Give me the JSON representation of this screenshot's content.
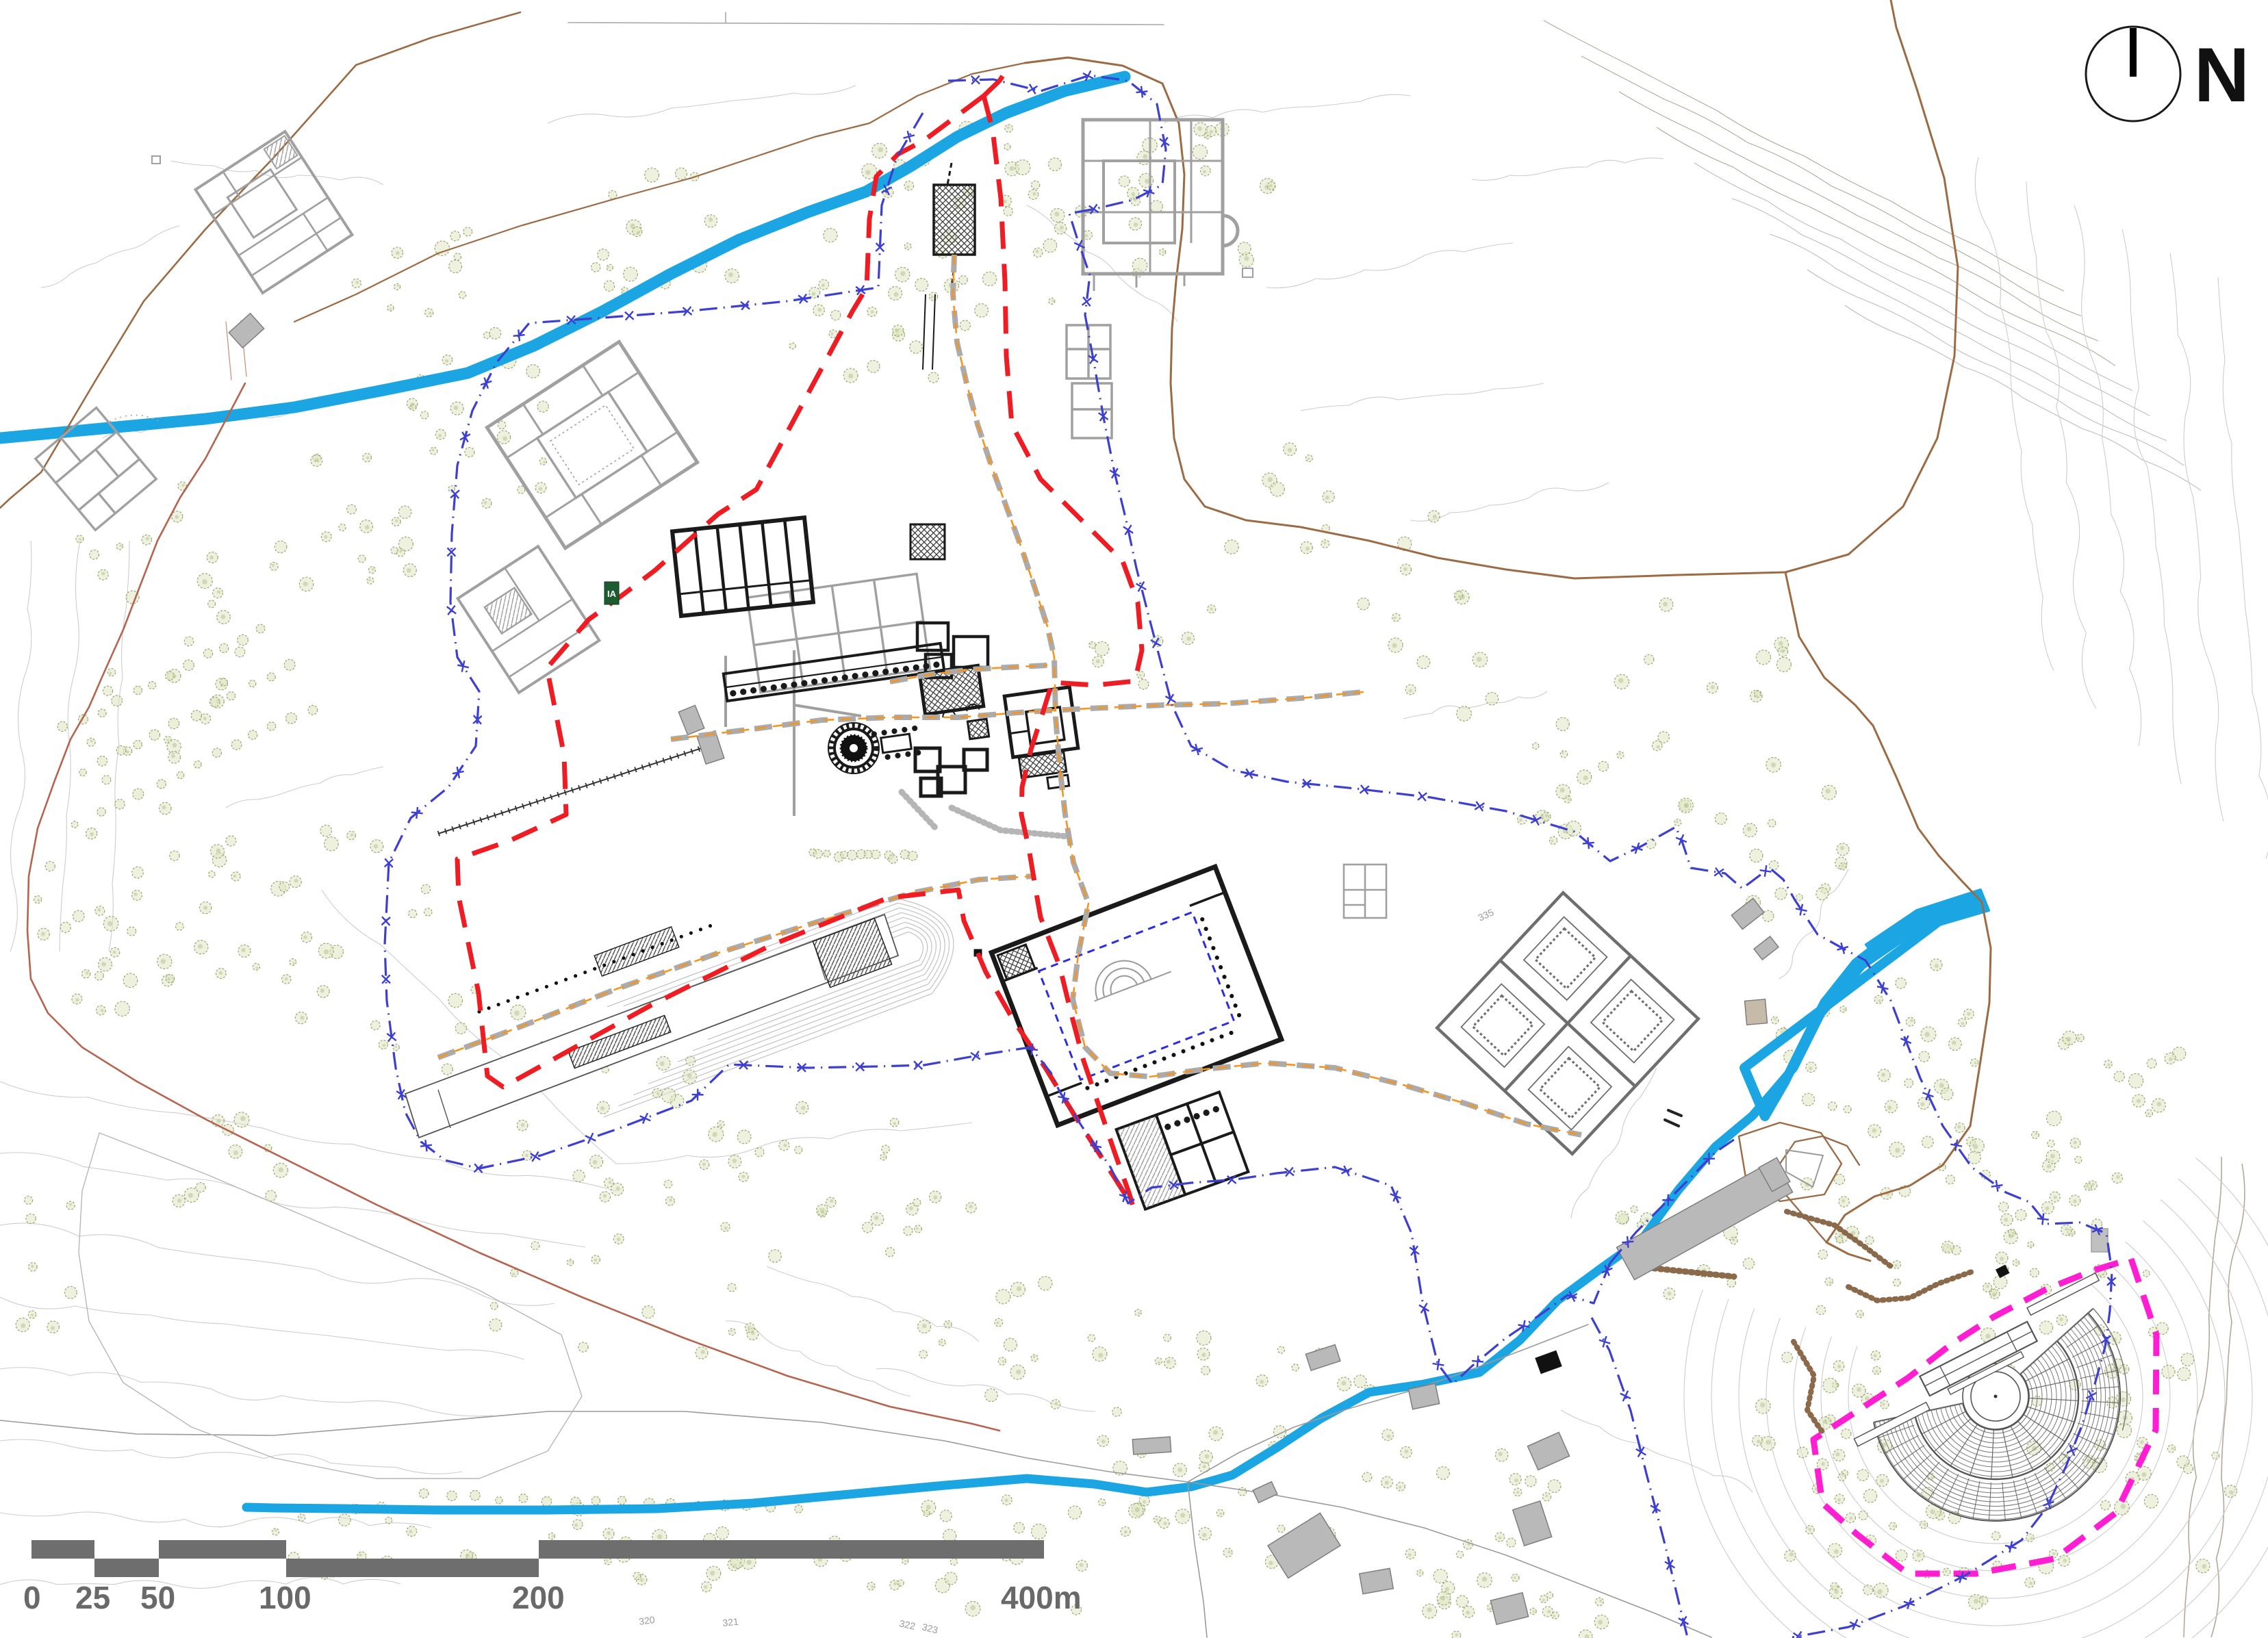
{
  "map": {
    "north_label": "N",
    "scale_bar": {
      "labels": [
        "0",
        "25",
        "50",
        "100",
        "200",
        "400m"
      ]
    },
    "contour_labels": [
      {
        "text": "320"
      },
      {
        "text": "321"
      },
      {
        "text": "322"
      },
      {
        "text": "323"
      },
      {
        "text": "335"
      }
    ],
    "site_marker_label": "IA",
    "colors": {
      "river": "#1ba6e3",
      "boundary_red": "#ee1c23",
      "fence_blue": "#3c3fd0",
      "boundary_magenta": "#ff1ed2",
      "path_orange": "#f7941d",
      "road_gray_dashed": "#ababab",
      "road_brown": "#9c6b44",
      "road_redbrown": "#b5654f",
      "contour": "#cdcdcd",
      "contour_brown": "#b3a89a",
      "tree_fill": "#dfe5c2",
      "tree_stroke": "#9aa871",
      "building_ancient_black": "#1a1a1a",
      "building_ancient_gray": "#a0a0a0",
      "building_modern_fill": "#b9b9b9",
      "scale_bar": "#6e6e6e",
      "peristyle_blue": "#2a2ee0"
    }
  }
}
